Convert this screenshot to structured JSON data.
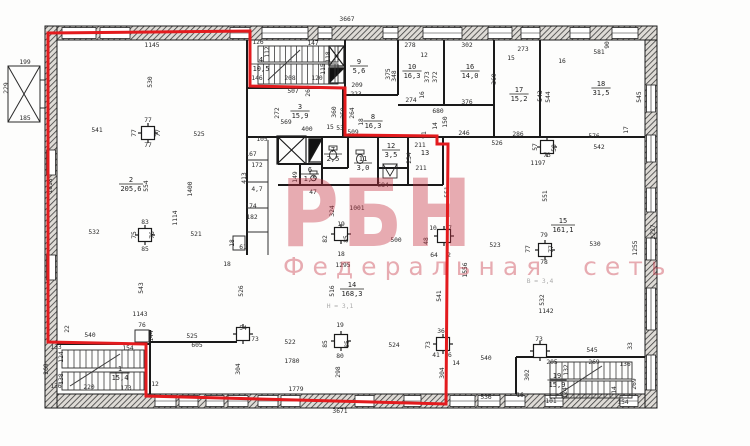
{
  "watermark": {
    "title": "РБН",
    "subtitle": "Федеральная сеть",
    "color": "rgba(198,47,66,0.40)"
  },
  "overlay": {
    "boundary_color": "#e31b1e"
  },
  "plan": {
    "rooms": [
      {
        "n": "1",
        "a": "15,4",
        "x": 120,
        "y": 371
      },
      {
        "n": "2",
        "a": "205,6",
        "x": 131,
        "y": 182
      },
      {
        "n": "3",
        "a": "15,9",
        "x": 300,
        "y": 109
      },
      {
        "n": "4",
        "a": "10,5",
        "x": 261,
        "y": 62
      },
      {
        "n": "6",
        "a": "1,5",
        "x": 310,
        "y": 172
      },
      {
        "n": "7",
        "a": "2,5",
        "x": 333,
        "y": 152
      },
      {
        "n": "8",
        "a": "16,3",
        "x": 373,
        "y": 119
      },
      {
        "n": "9",
        "a": "5,6",
        "x": 359,
        "y": 64
      },
      {
        "n": "10",
        "a": "16,3",
        "x": 412,
        "y": 69
      },
      {
        "n": "11",
        "a": "3,0",
        "x": 363,
        "y": 161
      },
      {
        "n": "12",
        "a": "3,5",
        "x": 391,
        "y": 148
      },
      {
        "n": "13",
        "a": "",
        "x": 425,
        "y": 155
      },
      {
        "n": "14",
        "a": "168,3",
        "x": 352,
        "y": 287
      },
      {
        "n": "15",
        "a": "161,1",
        "x": 563,
        "y": 223
      },
      {
        "n": "16",
        "a": "14,0",
        "x": 470,
        "y": 69
      },
      {
        "n": "17",
        "a": "15,2",
        "x": 519,
        "y": 92
      },
      {
        "n": "18",
        "a": "31,5",
        "x": 601,
        "y": 86
      },
      {
        "n": "19",
        "a": "15,9",
        "x": 557,
        "y": 378
      }
    ],
    "dims": [
      {
        "t": "3667",
        "x": 347,
        "y": 21
      },
      {
        "t": "1145",
        "x": 152,
        "y": 47
      },
      {
        "t": "90",
        "x": 609,
        "y": 45,
        "r": 1
      },
      {
        "t": "581",
        "x": 599,
        "y": 54
      },
      {
        "t": "16",
        "x": 562,
        "y": 63
      },
      {
        "t": "273",
        "x": 523,
        "y": 51
      },
      {
        "t": "15",
        "x": 511,
        "y": 60
      },
      {
        "t": "302",
        "x": 467,
        "y": 47
      },
      {
        "t": "12",
        "x": 424,
        "y": 57
      },
      {
        "t": "278",
        "x": 410,
        "y": 47
      },
      {
        "t": "126",
        "x": 258,
        "y": 44
      },
      {
        "t": "147",
        "x": 313,
        "y": 45
      },
      {
        "t": "112",
        "x": 269,
        "y": 52,
        "r": 1
      },
      {
        "t": "118",
        "x": 330,
        "y": 57,
        "r": 1
      },
      {
        "t": "115",
        "x": 325,
        "y": 69,
        "r": 1
      },
      {
        "t": "146",
        "x": 257,
        "y": 80
      },
      {
        "t": "208",
        "x": 290,
        "y": 80
      },
      {
        "t": "120",
        "x": 317,
        "y": 80
      },
      {
        "t": "209",
        "x": 357,
        "y": 87
      },
      {
        "t": "223",
        "x": 356,
        "y": 96
      },
      {
        "t": "269",
        "x": 310,
        "y": 91,
        "r": 1
      },
      {
        "t": "348",
        "x": 396,
        "y": 76,
        "r": 1
      },
      {
        "t": "375",
        "x": 390,
        "y": 74,
        "r": 1
      },
      {
        "t": "373",
        "x": 429,
        "y": 77,
        "r": 1
      },
      {
        "t": "372",
        "x": 437,
        "y": 77,
        "r": 1
      },
      {
        "t": "369",
        "x": 496,
        "y": 79,
        "r": 1
      },
      {
        "t": "543",
        "x": 542,
        "y": 96,
        "r": 1
      },
      {
        "t": "544",
        "x": 550,
        "y": 97,
        "r": 1
      },
      {
        "t": "545",
        "x": 641,
        "y": 97,
        "r": 1
      },
      {
        "t": "274",
        "x": 411,
        "y": 102
      },
      {
        "t": "376",
        "x": 467,
        "y": 104
      },
      {
        "t": "680",
        "x": 438,
        "y": 113
      },
      {
        "t": "16",
        "x": 424,
        "y": 95,
        "r": 1
      },
      {
        "t": "507",
        "x": 293,
        "y": 93
      },
      {
        "t": "569",
        "x": 286,
        "y": 124
      },
      {
        "t": "272",
        "x": 279,
        "y": 113,
        "r": 1
      },
      {
        "t": "400",
        "x": 307,
        "y": 131
      },
      {
        "t": "15",
        "x": 330,
        "y": 129
      },
      {
        "t": "53",
        "x": 340,
        "y": 130
      },
      {
        "t": "360",
        "x": 336,
        "y": 112,
        "r": 1
      },
      {
        "t": "259",
        "x": 345,
        "y": 113,
        "r": 1
      },
      {
        "t": "264",
        "x": 354,
        "y": 113,
        "r": 1
      },
      {
        "t": "18",
        "x": 363,
        "y": 122,
        "r": 1
      },
      {
        "t": "509",
        "x": 353,
        "y": 134
      },
      {
        "t": "14",
        "x": 437,
        "y": 126,
        "r": 1
      },
      {
        "t": "91",
        "x": 426,
        "y": 135,
        "r": 1
      },
      {
        "t": "150",
        "x": 447,
        "y": 122,
        "r": 1
      },
      {
        "t": "246",
        "x": 464,
        "y": 135
      },
      {
        "t": "286",
        "x": 518,
        "y": 136
      },
      {
        "t": "526",
        "x": 497,
        "y": 145
      },
      {
        "t": "576",
        "x": 594,
        "y": 138
      },
      {
        "t": "542",
        "x": 599,
        "y": 149
      },
      {
        "t": "17",
        "x": 628,
        "y": 130,
        "r": 1
      },
      {
        "t": "57",
        "x": 537,
        "y": 147,
        "r": 1
      },
      {
        "t": "58",
        "x": 556,
        "y": 148,
        "r": 1
      },
      {
        "t": "73",
        "x": 547,
        "y": 157
      },
      {
        "t": "1197",
        "x": 538,
        "y": 165
      },
      {
        "t": "105",
        "x": 262,
        "y": 141
      },
      {
        "t": "167",
        "x": 251,
        "y": 156
      },
      {
        "t": "172",
        "x": 257,
        "y": 167
      },
      {
        "t": "413",
        "x": 246,
        "y": 178,
        "r": 1
      },
      {
        "t": "4,7",
        "x": 257,
        "y": 191
      },
      {
        "t": "149",
        "x": 297,
        "y": 177,
        "r": 1
      },
      {
        "t": "47",
        "x": 313,
        "y": 194
      },
      {
        "t": "174",
        "x": 251,
        "y": 208
      },
      {
        "t": "182",
        "x": 252,
        "y": 219
      },
      {
        "t": "18",
        "x": 234,
        "y": 243,
        "r": 1
      },
      {
        "t": "61",
        "x": 243,
        "y": 249
      },
      {
        "t": "18",
        "x": 227,
        "y": 266
      },
      {
        "t": "526",
        "x": 243,
        "y": 291,
        "r": 1
      },
      {
        "t": "211",
        "x": 420,
        "y": 147
      },
      {
        "t": "211",
        "x": 421,
        "y": 170
      },
      {
        "t": "234",
        "x": 411,
        "y": 158,
        "r": 1
      },
      {
        "t": "684",
        "x": 383,
        "y": 187
      },
      {
        "t": "541",
        "x": 97,
        "y": 132
      },
      {
        "t": "525",
        "x": 199,
        "y": 136
      },
      {
        "t": "530",
        "x": 152,
        "y": 82,
        "r": 1
      },
      {
        "t": "77",
        "x": 148,
        "y": 122
      },
      {
        "t": "77",
        "x": 136,
        "y": 133,
        "r": 1
      },
      {
        "t": "77",
        "x": 160,
        "y": 133,
        "r": 1
      },
      {
        "t": "77",
        "x": 148,
        "y": 147
      },
      {
        "t": "554",
        "x": 148,
        "y": 186,
        "r": 1
      },
      {
        "t": "1400",
        "x": 192,
        "y": 189,
        "r": 1
      },
      {
        "t": "1818",
        "x": 52,
        "y": 186,
        "r": 1
      },
      {
        "t": "1114",
        "x": 177,
        "y": 218,
        "r": 1
      },
      {
        "t": "532",
        "x": 94,
        "y": 234
      },
      {
        "t": "521",
        "x": 196,
        "y": 236
      },
      {
        "t": "83",
        "x": 145,
        "y": 224
      },
      {
        "t": "75",
        "x": 136,
        "y": 235,
        "r": 1
      },
      {
        "t": "76",
        "x": 154,
        "y": 235,
        "r": 1
      },
      {
        "t": "85",
        "x": 145,
        "y": 251
      },
      {
        "t": "1001",
        "x": 357,
        "y": 210
      },
      {
        "t": "324",
        "x": 334,
        "y": 211,
        "r": 1
      },
      {
        "t": "500",
        "x": 396,
        "y": 242
      },
      {
        "t": "19",
        "x": 341,
        "y": 226
      },
      {
        "t": "82",
        "x": 327,
        "y": 239,
        "r": 1
      },
      {
        "t": "85",
        "x": 348,
        "y": 239,
        "r": 1
      },
      {
        "t": "18",
        "x": 341,
        "y": 256
      },
      {
        "t": "551",
        "x": 449,
        "y": 192,
        "r": 1
      },
      {
        "t": "551",
        "x": 547,
        "y": 196,
        "r": 1
      },
      {
        "t": "10",
        "x": 433,
        "y": 230
      },
      {
        "t": "7",
        "x": 450,
        "y": 230
      },
      {
        "t": "48",
        "x": 428,
        "y": 241,
        "r": 1
      },
      {
        "t": "64",
        "x": 434,
        "y": 257
      },
      {
        "t": "2",
        "x": 449,
        "y": 257
      },
      {
        "t": "1556",
        "x": 467,
        "y": 270,
        "r": 1
      },
      {
        "t": "2227",
        "x": 655,
        "y": 232,
        "r": 1
      },
      {
        "t": "1255",
        "x": 637,
        "y": 248,
        "r": 1
      },
      {
        "t": "523",
        "x": 495,
        "y": 247
      },
      {
        "t": "530",
        "x": 595,
        "y": 246
      },
      {
        "t": "79",
        "x": 544,
        "y": 237
      },
      {
        "t": "77",
        "x": 530,
        "y": 249,
        "r": 1
      },
      {
        "t": "77",
        "x": 553,
        "y": 249,
        "r": 1
      },
      {
        "t": "78",
        "x": 544,
        "y": 264
      },
      {
        "t": "543",
        "x": 143,
        "y": 288,
        "r": 1
      },
      {
        "t": "1143",
        "x": 140,
        "y": 316
      },
      {
        "t": "1142",
        "x": 546,
        "y": 313
      },
      {
        "t": "532",
        "x": 544,
        "y": 300,
        "r": 1
      },
      {
        "t": "516",
        "x": 334,
        "y": 291,
        "r": 1
      },
      {
        "t": "1295",
        "x": 343,
        "y": 267
      },
      {
        "t": "522",
        "x": 290,
        "y": 344
      },
      {
        "t": "524",
        "x": 394,
        "y": 347
      },
      {
        "t": "1780",
        "x": 292,
        "y": 363
      },
      {
        "t": "1779",
        "x": 296,
        "y": 391
      },
      {
        "t": "3671",
        "x": 340,
        "y": 413
      },
      {
        "t": "298",
        "x": 340,
        "y": 372,
        "r": 1
      },
      {
        "t": "304",
        "x": 240,
        "y": 369,
        "r": 1
      },
      {
        "t": "541",
        "x": 441,
        "y": 296,
        "r": 1
      },
      {
        "t": "19",
        "x": 340,
        "y": 327
      },
      {
        "t": "85",
        "x": 327,
        "y": 344,
        "r": 1
      },
      {
        "t": "85",
        "x": 349,
        "y": 344,
        "r": 1
      },
      {
        "t": "80",
        "x": 340,
        "y": 358
      },
      {
        "t": "36",
        "x": 441,
        "y": 333
      },
      {
        "t": "73",
        "x": 430,
        "y": 345,
        "r": 1
      },
      {
        "t": "41",
        "x": 436,
        "y": 357
      },
      {
        "t": "16",
        "x": 448,
        "y": 357
      },
      {
        "t": "14",
        "x": 456,
        "y": 365
      },
      {
        "t": "304",
        "x": 444,
        "y": 373,
        "r": 1
      },
      {
        "t": "540",
        "x": 486,
        "y": 360
      },
      {
        "t": "536",
        "x": 486,
        "y": 399
      },
      {
        "t": "540",
        "x": 90,
        "y": 337
      },
      {
        "t": "76",
        "x": 142,
        "y": 327
      },
      {
        "t": "22",
        "x": 69,
        "y": 329,
        "r": 1
      },
      {
        "t": "144",
        "x": 153,
        "y": 336,
        "r": 1
      },
      {
        "t": "525",
        "x": 192,
        "y": 338
      },
      {
        "t": "605",
        "x": 197,
        "y": 347
      },
      {
        "t": "54",
        "x": 243,
        "y": 330
      },
      {
        "t": "73",
        "x": 255,
        "y": 341
      },
      {
        "t": "133",
        "x": 56,
        "y": 349
      },
      {
        "t": "124",
        "x": 63,
        "y": 357,
        "r": 1
      },
      {
        "t": "154",
        "x": 128,
        "y": 350
      },
      {
        "t": "138",
        "x": 63,
        "y": 379,
        "r": 1
      },
      {
        "t": "136",
        "x": 56,
        "y": 388
      },
      {
        "t": "220",
        "x": 89,
        "y": 389
      },
      {
        "t": "173",
        "x": 126,
        "y": 390
      },
      {
        "t": "12",
        "x": 155,
        "y": 386
      },
      {
        "t": "269",
        "x": 48,
        "y": 369,
        "r": 1
      },
      {
        "t": "199",
        "x": 25,
        "y": 64
      },
      {
        "t": "229",
        "x": 8,
        "y": 88,
        "r": 1
      },
      {
        "t": "185",
        "x": 25,
        "y": 120
      },
      {
        "t": "73",
        "x": 539,
        "y": 341
      },
      {
        "t": "545",
        "x": 592,
        "y": 352
      },
      {
        "t": "205",
        "x": 552,
        "y": 364
      },
      {
        "t": "269",
        "x": 594,
        "y": 364
      },
      {
        "t": "136",
        "x": 625,
        "y": 366
      },
      {
        "t": "33",
        "x": 632,
        "y": 346,
        "r": 1
      },
      {
        "t": "302",
        "x": 529,
        "y": 375,
        "r": 1
      },
      {
        "t": "132",
        "x": 568,
        "y": 370,
        "r": 1
      },
      {
        "t": "124",
        "x": 567,
        "y": 393,
        "r": 1
      },
      {
        "t": "16",
        "x": 520,
        "y": 397
      },
      {
        "t": "101",
        "x": 551,
        "y": 403
      },
      {
        "t": "154",
        "x": 623,
        "y": 404
      },
      {
        "t": "14",
        "x": 616,
        "y": 390,
        "r": 1
      },
      {
        "t": "269",
        "x": 636,
        "y": 384,
        "r": 1
      },
      {
        "t": "Н = 3,1",
        "x": 340,
        "y": 308,
        "f": 1
      },
      {
        "t": "В = 3,4",
        "x": 540,
        "y": 283,
        "f": 1
      }
    ]
  }
}
